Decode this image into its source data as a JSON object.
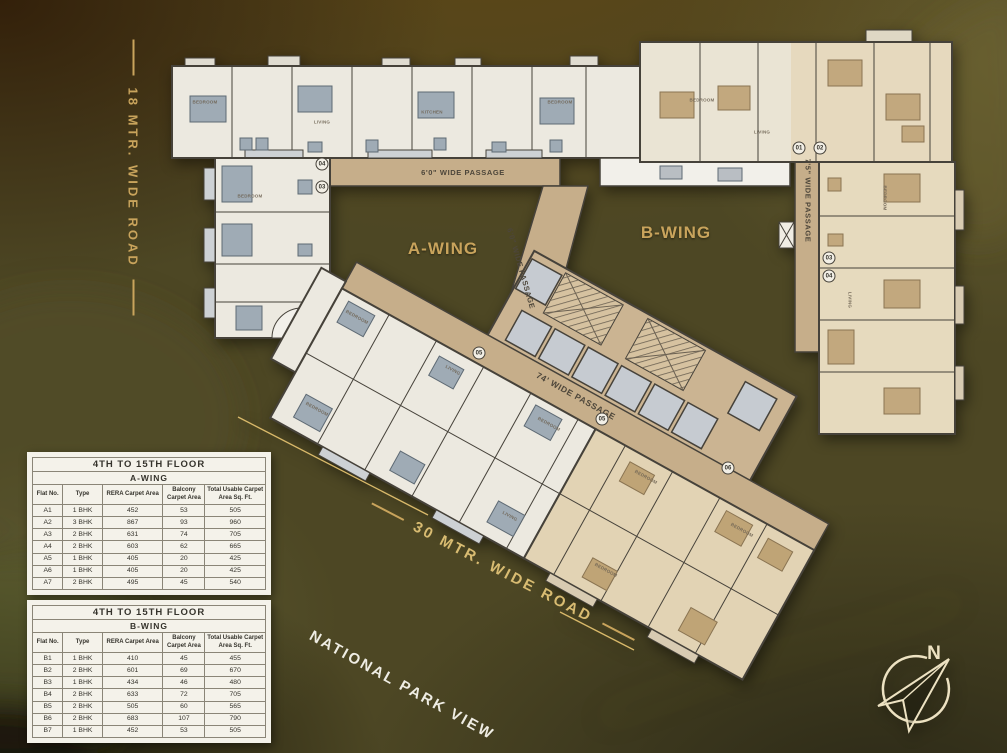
{
  "roads": {
    "left": "18 MTR. WIDE ROAD",
    "bottom": "30 MTR. WIDE ROAD",
    "park_view": "NATIONAL PARK VIEW"
  },
  "compass": {
    "north": "N"
  },
  "plan": {
    "wing_a": "A-WING",
    "wing_b": "B-WING",
    "passage_top": "6'0\" WIDE PASSAGE",
    "passage_diagonal": "6'0\" WIDE PASSAGE",
    "passage_main": "74' WIDE PASSAGE",
    "passage_right": "7'5\" WIDE PASSAGE",
    "markers": [
      {
        "t": "04",
        "x": 322,
        "y": 164,
        "c": "unit",
        "r": 0
      },
      {
        "t": "03",
        "x": 322,
        "y": 187,
        "c": "unit",
        "r": 0
      },
      {
        "t": "01",
        "x": 799,
        "y": 148,
        "c": "unit",
        "r": 0
      },
      {
        "t": "02",
        "x": 820,
        "y": 148,
        "c": "unit",
        "r": 0
      },
      {
        "t": "03",
        "x": 829,
        "y": 258,
        "c": "unit",
        "r": 0
      },
      {
        "t": "04",
        "x": 829,
        "y": 276,
        "c": "unit",
        "r": 0
      },
      {
        "t": "05",
        "x": 479,
        "y": 353,
        "c": "unit",
        "r": 0
      },
      {
        "t": "05",
        "x": 602,
        "y": 419,
        "c": "unit",
        "r": 0
      },
      {
        "t": "06",
        "x": 728,
        "y": 468,
        "c": "unit",
        "r": 0
      },
      {
        "t": "BEDROOM",
        "x": 205,
        "y": 102,
        "c": "room",
        "r": 0
      },
      {
        "t": "LIVING",
        "x": 322,
        "y": 122,
        "c": "room",
        "r": 0
      },
      {
        "t": "KITCHEN",
        "x": 432,
        "y": 112,
        "c": "room",
        "r": 0
      },
      {
        "t": "BEDROOM",
        "x": 560,
        "y": 102,
        "c": "room",
        "r": 0
      },
      {
        "t": "BEDROOM",
        "x": 702,
        "y": 100,
        "c": "room",
        "r": 0
      },
      {
        "t": "LIVING",
        "x": 762,
        "y": 132,
        "c": "room",
        "r": 0
      },
      {
        "t": "BEDROOM",
        "x": 250,
        "y": 196,
        "c": "room",
        "r": 0
      },
      {
        "t": "BEDROOM",
        "x": 885,
        "y": 198,
        "c": "room",
        "r": 90
      },
      {
        "t": "LIVING",
        "x": 850,
        "y": 300,
        "c": "room",
        "r": 90
      },
      {
        "t": "BEDROOM",
        "x": 357,
        "y": 317,
        "c": "room",
        "r": 29
      },
      {
        "t": "LIVING",
        "x": 453,
        "y": 370,
        "c": "room",
        "r": 29
      },
      {
        "t": "BEDROOM",
        "x": 549,
        "y": 424,
        "c": "room",
        "r": 29
      },
      {
        "t": "BEDROOM",
        "x": 646,
        "y": 477,
        "c": "room",
        "r": 29
      },
      {
        "t": "BEDROOM",
        "x": 742,
        "y": 530,
        "c": "room",
        "r": 29
      },
      {
        "t": "BEDROOM",
        "x": 317,
        "y": 409,
        "c": "room",
        "r": 29
      },
      {
        "t": "LIVING",
        "x": 510,
        "y": 516,
        "c": "room",
        "r": 29
      },
      {
        "t": "BEDROOM",
        "x": 606,
        "y": 570,
        "c": "room",
        "r": 29
      }
    ]
  },
  "tables": [
    {
      "floor": "4TH TO 15TH FLOOR",
      "wing": "A-WING",
      "columns": [
        "Flat No.",
        "Type",
        "RERA Carpet Area",
        "Balcony Carpet Area",
        "Total Usable Carpet Area Sq. Ft."
      ],
      "rows": [
        [
          "A1",
          "1 BHK",
          "452",
          "53",
          "505"
        ],
        [
          "A2",
          "3 BHK",
          "867",
          "93",
          "960"
        ],
        [
          "A3",
          "2 BHK",
          "631",
          "74",
          "705"
        ],
        [
          "A4",
          "2 BHK",
          "603",
          "62",
          "665"
        ],
        [
          "A5",
          "1 BHK",
          "405",
          "20",
          "425"
        ],
        [
          "A6",
          "1 BHK",
          "405",
          "20",
          "425"
        ],
        [
          "A7",
          "2 BHK",
          "495",
          "45",
          "540"
        ]
      ]
    },
    {
      "floor": "4TH TO 15TH FLOOR",
      "wing": "B-WING",
      "columns": [
        "Flat No.",
        "Type",
        "RERA Carpet Area",
        "Balcony Carpet Area",
        "Total Usable Carpet Area Sq. Ft."
      ],
      "rows": [
        [
          "B1",
          "1 BHK",
          "410",
          "45",
          "455"
        ],
        [
          "B2",
          "2 BHK",
          "601",
          "69",
          "670"
        ],
        [
          "B3",
          "1 BHK",
          "434",
          "46",
          "480"
        ],
        [
          "B4",
          "2 BHK",
          "633",
          "72",
          "705"
        ],
        [
          "B5",
          "2 BHK",
          "505",
          "60",
          "565"
        ],
        [
          "B6",
          "2 BHK",
          "683",
          "107",
          "790"
        ],
        [
          "B7",
          "1 BHK",
          "452",
          "53",
          "505"
        ]
      ]
    }
  ],
  "colors": {
    "gold": "#C9A45C",
    "cream": "#EDE2C2",
    "passage_beige": "#C6AE8A",
    "room_light": "#ECE9E0",
    "room_tan": "#E2D3B4"
  }
}
